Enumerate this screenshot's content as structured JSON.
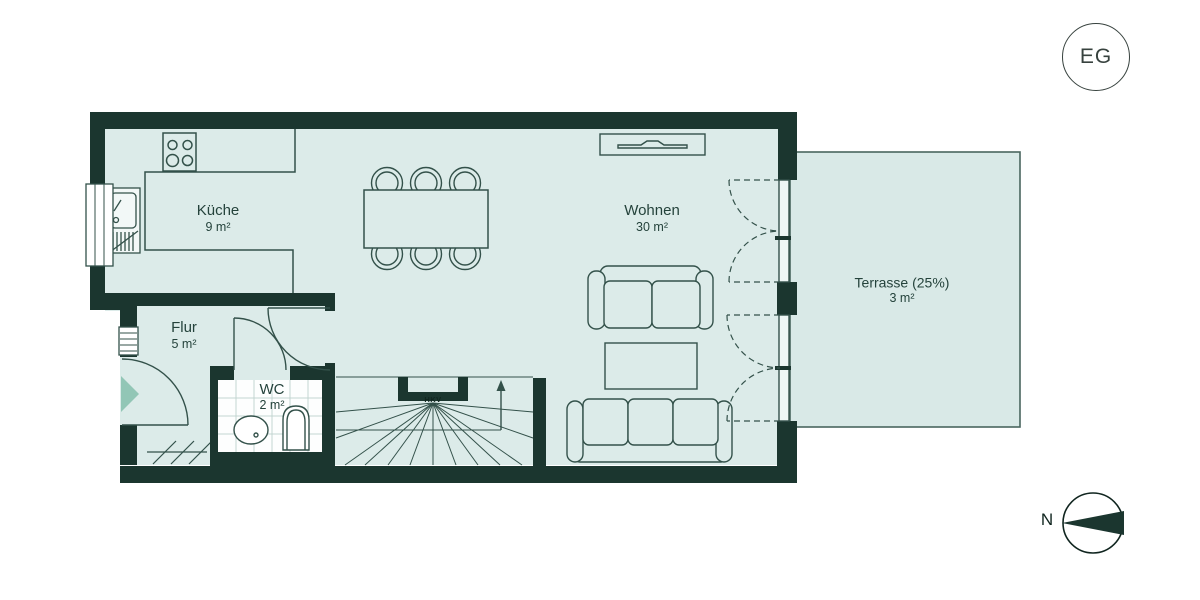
{
  "floor_badge": {
    "label": "EG"
  },
  "compass": {
    "label": "N"
  },
  "rooms": {
    "kueche": {
      "name": "Küche",
      "area": "9 m²"
    },
    "wohnen": {
      "name": "Wohnen",
      "area": "30 m²"
    },
    "flur": {
      "name": "Flur",
      "area": "5 m²"
    },
    "wc": {
      "name": "WC",
      "area": "2 m²"
    },
    "terrasse": {
      "name": "Terrasse (25%)",
      "area": "3 m²"
    }
  },
  "annotations": {
    "hkv": "HKV"
  },
  "colors": {
    "wall": "#1b362f",
    "floor": "#dcebe9",
    "terrace": "#d9e9e7",
    "line": "#33514a",
    "entry": "#92c6b6",
    "text": "#24423b"
  }
}
